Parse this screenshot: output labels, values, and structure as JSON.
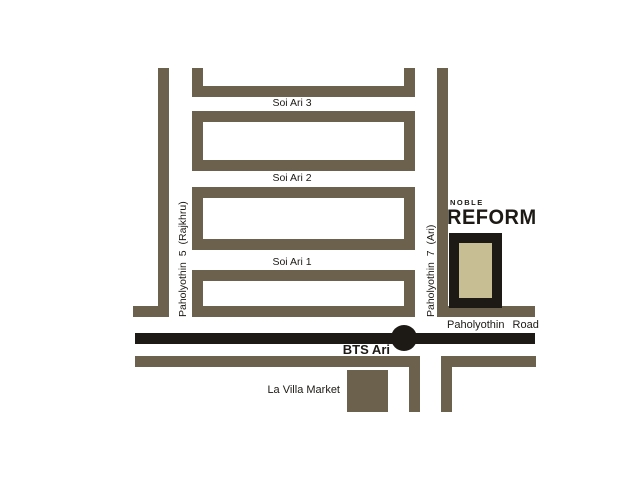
{
  "map": {
    "roads": {
      "paholyothin_5_label": "Paholyothin 5  (Rajkhru)",
      "paholyothin_7_label": "Paholyothin 7  (Ari)",
      "paholyothin_road_label": "Paholyothin  Road",
      "soi_ari_3_label": "Soi Ari 3",
      "soi_ari_2_label": "Soi Ari 2",
      "soi_ari_1_label": "Soi Ari 1"
    },
    "station": {
      "label": "BTS Ari"
    },
    "market": {
      "label": "La Villa Market"
    },
    "logo": {
      "brand": "NOBLE REFORM",
      "top": "NOBLE",
      "wordmark": "REFORM"
    },
    "colors": {
      "road_brown": "#6b614c",
      "main_road_black": "#1d1a15",
      "building_fill_tan": "#c7be94",
      "background": "#ffffff"
    }
  }
}
